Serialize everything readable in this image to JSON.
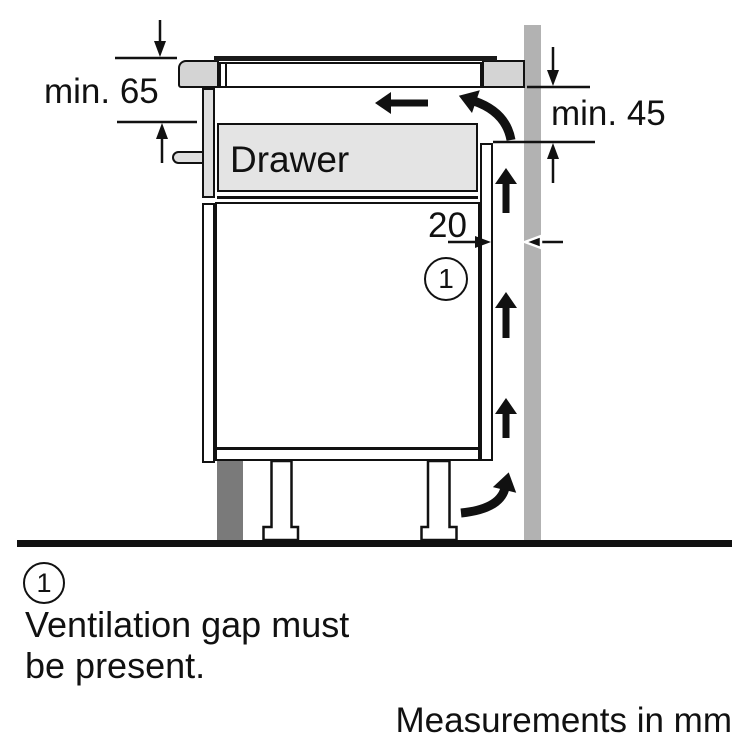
{
  "figure": {
    "drawer_label": "Drawer",
    "dimensions": {
      "hob_clearance": "min. 65",
      "wall_clearance": "min. 45",
      "ventilation_gap": "20"
    },
    "callout": "1"
  },
  "legend": {
    "callout": "1",
    "note_line1": "Ventilation gap must",
    "note_line2": "be present.",
    "units": "Measurements in mm"
  },
  "colors": {
    "background": "#ffffff",
    "line": "#111111",
    "glass": "#1a1a1a",
    "wall": "#b2b2b2",
    "plinth": "#7a7a7a",
    "panel": "#e4e4e4",
    "panel_front": "#dfdfdf",
    "trim": "#d4d4d4"
  }
}
